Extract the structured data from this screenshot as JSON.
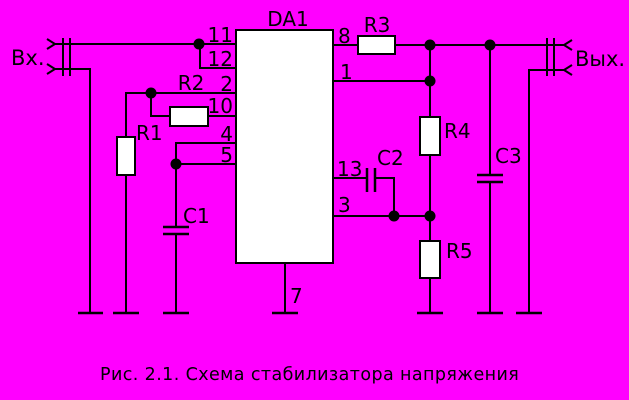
{
  "colors": {
    "background": "#FF00FF",
    "wire": "#000000",
    "component_fill": "#FFFFFF"
  },
  "ic": {
    "designator": "DA1"
  },
  "pins": {
    "left": [
      "11",
      "12",
      "2",
      "10",
      "4",
      "5"
    ],
    "right": [
      "8",
      "1",
      "13",
      "3"
    ],
    "bottom": [
      "7"
    ]
  },
  "components": {
    "r1": "R1",
    "r2": "R2",
    "r3": "R3",
    "r4": "R4",
    "r5": "R5",
    "c1": "C1",
    "c2": "C2",
    "c3": "C3"
  },
  "terminals": {
    "input": "Вх.",
    "output": "Вых."
  },
  "caption": "Рис. 2.1. Схема стабилизатора напряжения"
}
